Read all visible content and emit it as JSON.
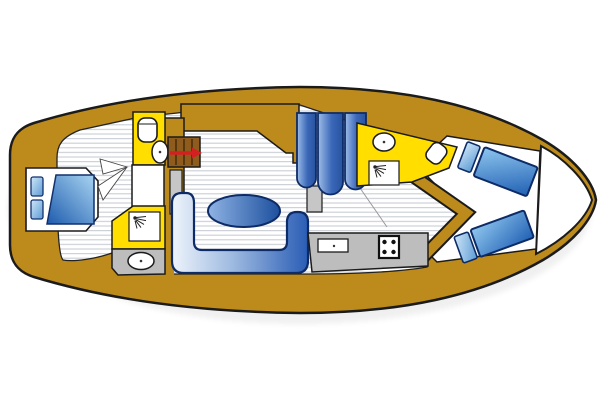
{
  "title": "Yacht interior layout plan (top view)",
  "colors": {
    "deck": "#BD8A1C",
    "hull_outline": "#1B1B1B",
    "room_yellow": "#FFDE00",
    "counter_gray": "#BDBDBD",
    "post_gray": "#C6C6C6",
    "steps_brown": "#8F5C1D",
    "accent_red": "#D42020",
    "furniture_outline_navy": "#0D2B66",
    "floor_white": "#FFFFFF",
    "stripe_gray": "#C9CED4"
  },
  "rooms": [
    {
      "id": "bow-tip",
      "name": "bow tip locker"
    },
    {
      "id": "owner-cabin",
      "name": "forward cabin with double bed"
    },
    {
      "id": "head-forward",
      "name": "forward head with toilet and washbasin"
    },
    {
      "id": "shower-forward",
      "name": "forward shower compartment"
    },
    {
      "id": "salon",
      "name": "salon with U-settee and oval table"
    },
    {
      "id": "wardrobe",
      "name": "hanging locker with three panels"
    },
    {
      "id": "galley",
      "name": "galley with sink and four-burner stove"
    },
    {
      "id": "head-aft",
      "name": "aft head with basin, toilet and shower"
    },
    {
      "id": "aft-cabin",
      "name": "aft cabin with two single berths"
    }
  ],
  "icons": [
    "toilet-icon",
    "washbasin-icon",
    "shower-spray-icon",
    "stove-burners-icon",
    "companionway-steps-icon",
    "direction-arrow-icon",
    "bed-icon",
    "table-icon"
  ],
  "counts": {
    "wardrobe_panels": 3,
    "stove_burners": 4,
    "single_berths": 2,
    "double_beds": 1,
    "sinks": 4
  }
}
